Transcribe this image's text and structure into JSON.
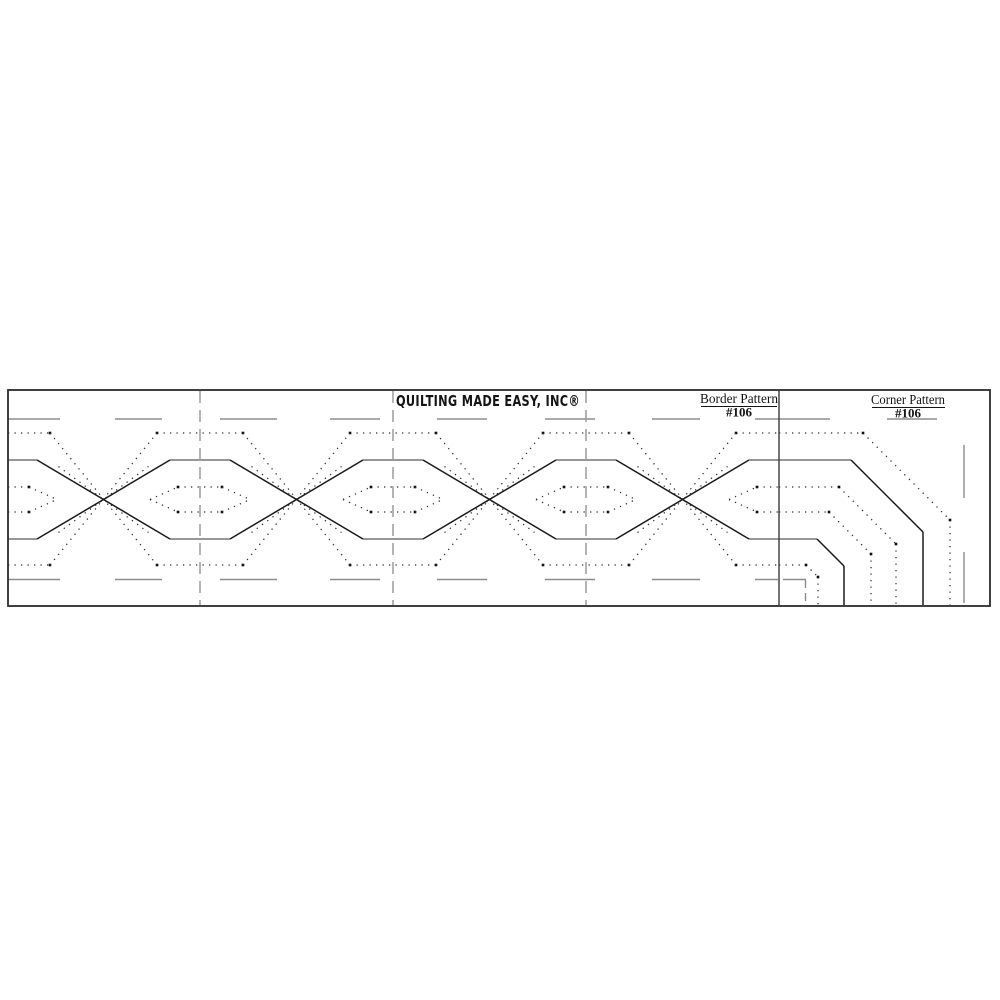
{
  "header": {
    "brand": "QUILTING MADE EASY, INC®",
    "border_label": "Border Pattern",
    "border_number": "#106",
    "corner_label": "Corner Pattern",
    "corner_number": "#106"
  },
  "pattern": {
    "colors": {
      "ink": "#1a1a1a",
      "grayline": "#757575",
      "guide": "#8d8d8d",
      "dot": "#2f2f2f",
      "separator": "#9c9c9c",
      "frame": "#2b2b2b",
      "background": "#ffffff"
    },
    "strip": {
      "x": 8,
      "y": 390,
      "w": 982,
      "h": 216
    },
    "rows": {
      "guide_top": 419,
      "outer_top": 433,
      "solid_top": 460,
      "lens_top": 487,
      "center": 499.5,
      "lens_bot": 512,
      "solid_bot": 539,
      "outer_bot": 565,
      "guide_bot": 579.5
    },
    "repeat": {
      "period": 193,
      "centers": [
        7,
        200,
        393,
        586,
        779
      ],
      "midpoints": [
        103.5,
        296.5,
        489.5,
        682.5
      ],
      "separators": [
        200,
        393,
        586
      ],
      "divider": 779
    },
    "half": {
      "solid": 30,
      "outer": 43,
      "flat": 22,
      "point": 50,
      "shallow": 45,
      "shallow_y": 33
    },
    "guide_dashes_top": [
      [
        8,
        60
      ],
      [
        115,
        162
      ],
      [
        220,
        277
      ],
      [
        330,
        380
      ],
      [
        437,
        487
      ],
      [
        545,
        595
      ],
      [
        652,
        700
      ],
      [
        755,
        830
      ],
      [
        887,
        937
      ]
    ],
    "guide_dashes_bottom": [
      [
        8,
        60
      ],
      [
        115,
        162
      ],
      [
        220,
        277
      ],
      [
        330,
        380
      ],
      [
        437,
        487
      ],
      [
        545,
        595
      ],
      [
        652,
        700
      ],
      [
        755,
        778
      ],
      [
        783,
        806
      ]
    ],
    "guide_vertical_right": {
      "x": 964,
      "segments": [
        [
          445,
          498
        ],
        [
          552,
          603
        ]
      ]
    },
    "guide_bracket": {
      "x": 805.5,
      "segments": [
        [
          580,
          588
        ],
        [
          593,
          601
        ]
      ]
    },
    "corner": {
      "edge_x": 779,
      "bottom_y": 605,
      "mirror_sum": 1383,
      "lines": [
        {
          "y": 433,
          "dotted": true,
          "chamfer": 87
        },
        {
          "y": 460,
          "dotted": false,
          "chamfer": 72
        },
        {
          "y": 487,
          "dotted": true,
          "chamfer": 57
        },
        {
          "y": 512,
          "dotted": true,
          "chamfer": 42
        },
        {
          "y": 539,
          "dotted": false,
          "chamfer": 27
        },
        {
          "y": 565,
          "dotted": true,
          "chamfer": 12
        }
      ]
    }
  }
}
